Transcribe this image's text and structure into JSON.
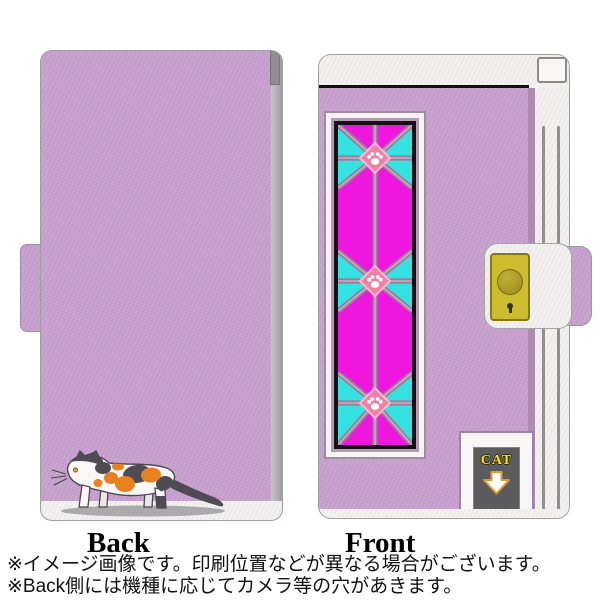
{
  "views": {
    "back": {
      "label": "Back"
    },
    "front": {
      "label": "Front"
    },
    "cat_door": {
      "label": "CAT"
    }
  },
  "notes": [
    "※イメージ画像です。印刷位置などが異なる場合がございます。",
    "※Back側には機種に応じてカメラ等の穴があきます。"
  ],
  "colors": {
    "case_purple": "#C7A0CE",
    "glass_magenta": "#EF16DF",
    "glass_cyan": "#35E2E2",
    "lattice_mauve": "#9B7E97",
    "medallion_pink": "#EE82A6",
    "clasp_yellow": "#CDBD2E",
    "cat_orange": "#E8821E",
    "cat_dark_gray": "#4E4B54",
    "arrow_outline_orange": "#E29A2E",
    "frame_black": "#151015",
    "text_black": "#111111"
  }
}
